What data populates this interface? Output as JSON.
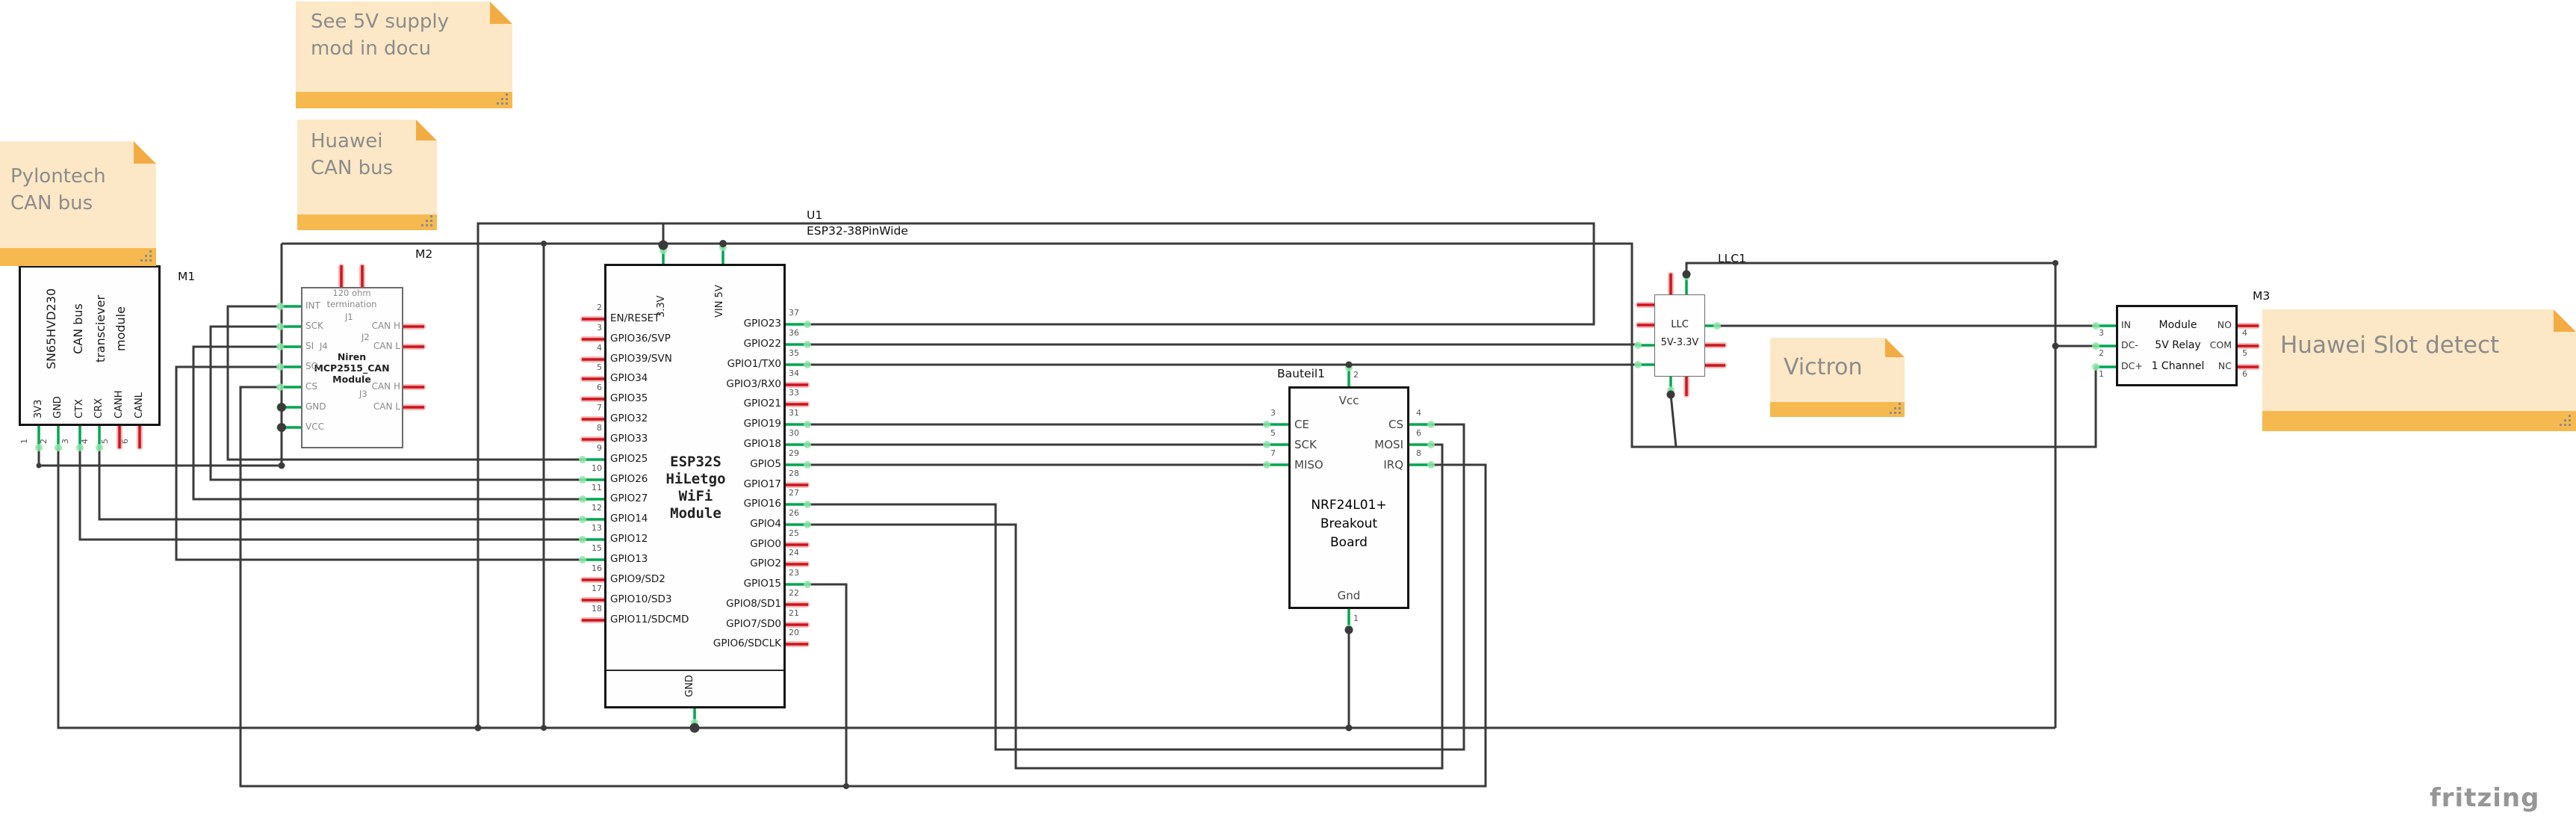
{
  "app": {
    "watermark": "fritzing"
  },
  "colors": {
    "wire": "#3b3b3b",
    "pin_green": "#00A650",
    "pin_red": "#D2232A",
    "note_bg": "#FCE8C6",
    "note_bar": "#F6B94F",
    "note_text": "#8C8C8C"
  },
  "notes": {
    "supply": {
      "line1": "See 5V supply",
      "line2": "mod in docu"
    },
    "huawei_can": {
      "line1": "Huawei",
      "line2": "CAN bus"
    },
    "pylontech": {
      "line1": "Pylontech",
      "line2": "CAN bus"
    },
    "victron": {
      "line1": "Victron"
    },
    "huawei_slot": {
      "line1": "Huawei Slot detect"
    }
  },
  "m1": {
    "ref": "M1",
    "title1": "SN65HVD230",
    "title2": "CAN bus",
    "title3": "transciever",
    "title4": "module",
    "pins": [
      {
        "num": "1",
        "label": "3V3"
      },
      {
        "num": "2",
        "label": "GND"
      },
      {
        "num": "3",
        "label": "CTX"
      },
      {
        "num": "4",
        "label": "CRX"
      },
      {
        "num": "5",
        "label": "CANH"
      },
      {
        "num": "6",
        "label": "CANL"
      }
    ]
  },
  "m2": {
    "ref": "M2",
    "top1": "120 ohm",
    "top2": "termination",
    "j1": "J1",
    "j2": "J2",
    "j3": "J3",
    "j4": "J4",
    "name1": "Niren",
    "name2": "MCP2515_CAN",
    "name3": "Module",
    "left_pins": [
      "INT",
      "SCK",
      "SI",
      "SO",
      "CS",
      "GND",
      "VCC"
    ],
    "right_pins": [
      "CAN H",
      "CAN L",
      "CAN H",
      "CAN L"
    ]
  },
  "esp32": {
    "ref": "U1",
    "part": "ESP32-38PinWide",
    "top_pin1": "3.3V",
    "top_pin2": "VIN 5V",
    "bottom_pin": "GND",
    "center1": "ESP32S",
    "center2": "HiLetgo",
    "center3": "WiFi",
    "center4": "Module",
    "left_pins": [
      {
        "num": "2",
        "label": "EN/RESET"
      },
      {
        "num": "3",
        "label": "GPIO36/SVP"
      },
      {
        "num": "4",
        "label": "GPIO39/SVN"
      },
      {
        "num": "5",
        "label": "GPIO34"
      },
      {
        "num": "6",
        "label": "GPIO35"
      },
      {
        "num": "7",
        "label": "GPIO32"
      },
      {
        "num": "8",
        "label": "GPIO33"
      },
      {
        "num": "9",
        "label": "GPIO25"
      },
      {
        "num": "10",
        "label": "GPIO26"
      },
      {
        "num": "11",
        "label": "GPIO27"
      },
      {
        "num": "12",
        "label": "GPIO14"
      },
      {
        "num": "13",
        "label": "GPIO12"
      },
      {
        "num": "15",
        "label": "GPIO13"
      },
      {
        "num": "16",
        "label": "GPIO9/SD2"
      },
      {
        "num": "17",
        "label": "GPIO10/SD3"
      },
      {
        "num": "18",
        "label": "GPIO11/SDCMD"
      }
    ],
    "right_pins": [
      {
        "num": "37",
        "label": "GPIO23"
      },
      {
        "num": "36",
        "label": "GPIO22"
      },
      {
        "num": "35",
        "label": "GPIO1/TX0"
      },
      {
        "num": "34",
        "label": "GPIO3/RX0"
      },
      {
        "num": "33",
        "label": "GPIO21"
      },
      {
        "num": "31",
        "label": "GPIO19"
      },
      {
        "num": "30",
        "label": "GPIO18"
      },
      {
        "num": "29",
        "label": "GPIO5"
      },
      {
        "num": "28",
        "label": "GPIO17"
      },
      {
        "num": "27",
        "label": "GPIO16"
      },
      {
        "num": "26",
        "label": "GPIO4"
      },
      {
        "num": "25",
        "label": "GPIO0"
      },
      {
        "num": "24",
        "label": "GPIO2"
      },
      {
        "num": "23",
        "label": "GPIO15"
      },
      {
        "num": "22",
        "label": "GPIO8/SD1"
      },
      {
        "num": "21",
        "label": "GPIO7/SD0"
      },
      {
        "num": "20",
        "label": "GPIO6/SDCLK"
      }
    ]
  },
  "nrf": {
    "ref": "Bauteil1",
    "title1": "NRF24L01+",
    "title2": "Breakout",
    "title3": "Board",
    "vcc": "Vcc",
    "gnd": "Gnd",
    "top_num": "2",
    "bottom_num": "1",
    "left_pins": [
      {
        "num": "3",
        "label": "CE"
      },
      {
        "num": "5",
        "label": "SCK"
      },
      {
        "num": "7",
        "label": "MISO"
      }
    ],
    "right_pins": [
      {
        "num": "4",
        "label": "CS"
      },
      {
        "num": "6",
        "label": "MOSI"
      },
      {
        "num": "8",
        "label": "IRQ"
      }
    ]
  },
  "llc": {
    "ref": "LLC1",
    "line1": "LLC",
    "line2": "5V-3.3V"
  },
  "m3": {
    "ref": "M3",
    "center1": "Module",
    "center2": "5V Relay",
    "center3": "1 Channel",
    "left_pins": [
      {
        "num": "3",
        "label": "IN"
      },
      {
        "num": "2",
        "label": "DC-"
      },
      {
        "num": "1",
        "label": "DC+"
      }
    ],
    "right_pins": [
      {
        "num": "4",
        "label": "NO"
      },
      {
        "num": "5",
        "label": "COM"
      },
      {
        "num": "6",
        "label": "NC"
      }
    ]
  }
}
